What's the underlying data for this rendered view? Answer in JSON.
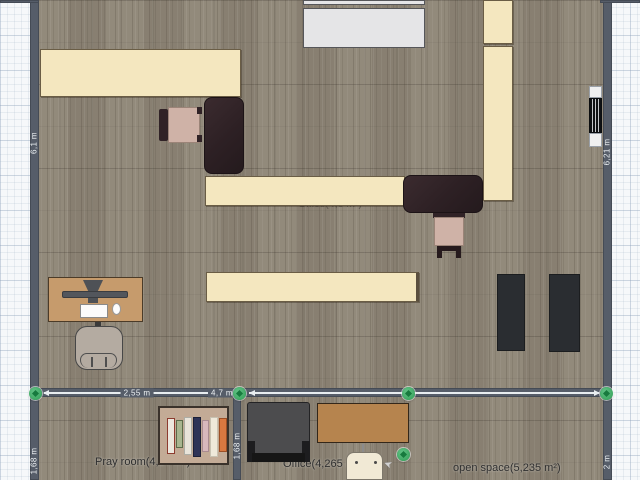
{
  "rooms": {
    "pray_room_label": "Pray room(4,27 m²)",
    "office_bottom_label": "Office(4,265 m²)",
    "open_space_label": "open space(5,235 m²)",
    "office_main_label": "Office(4,6 m²)"
  },
  "measurements": {
    "left_wall_top": "6,1 m",
    "left_wall_bottom": "1,68 m",
    "divider_wall": "1,68 m",
    "right_wall_top": "6,21 m",
    "right_wall_bottom": "2 m",
    "bottom_wall_left_segment": "2,55 m",
    "bottom_wall_right_segment": "4,7 m"
  },
  "palette": {
    "wall": "#565d69",
    "floor": "#8e8576",
    "grid_background": "#f6f8fa",
    "cream_furniture": "#f4e7bf",
    "dark_desk": "#2f2226",
    "white_table": "#e5e5e7",
    "tan_computer_desk": "#c69b6c",
    "office_desk_brown": "#b6844e",
    "chair_pink": "#cfb2a7",
    "sofa_gray": "#4c4c4e",
    "mat_dark": "#2a2d31",
    "handle_green": "#3cab63",
    "bookshelf_tan": "#c3ab96",
    "book_colors": [
      "#ece7dd",
      "#a8b58f",
      "#e9e4da",
      "#2e3357",
      "#d8b8bc",
      "#efe9da",
      "#d97840"
    ]
  }
}
